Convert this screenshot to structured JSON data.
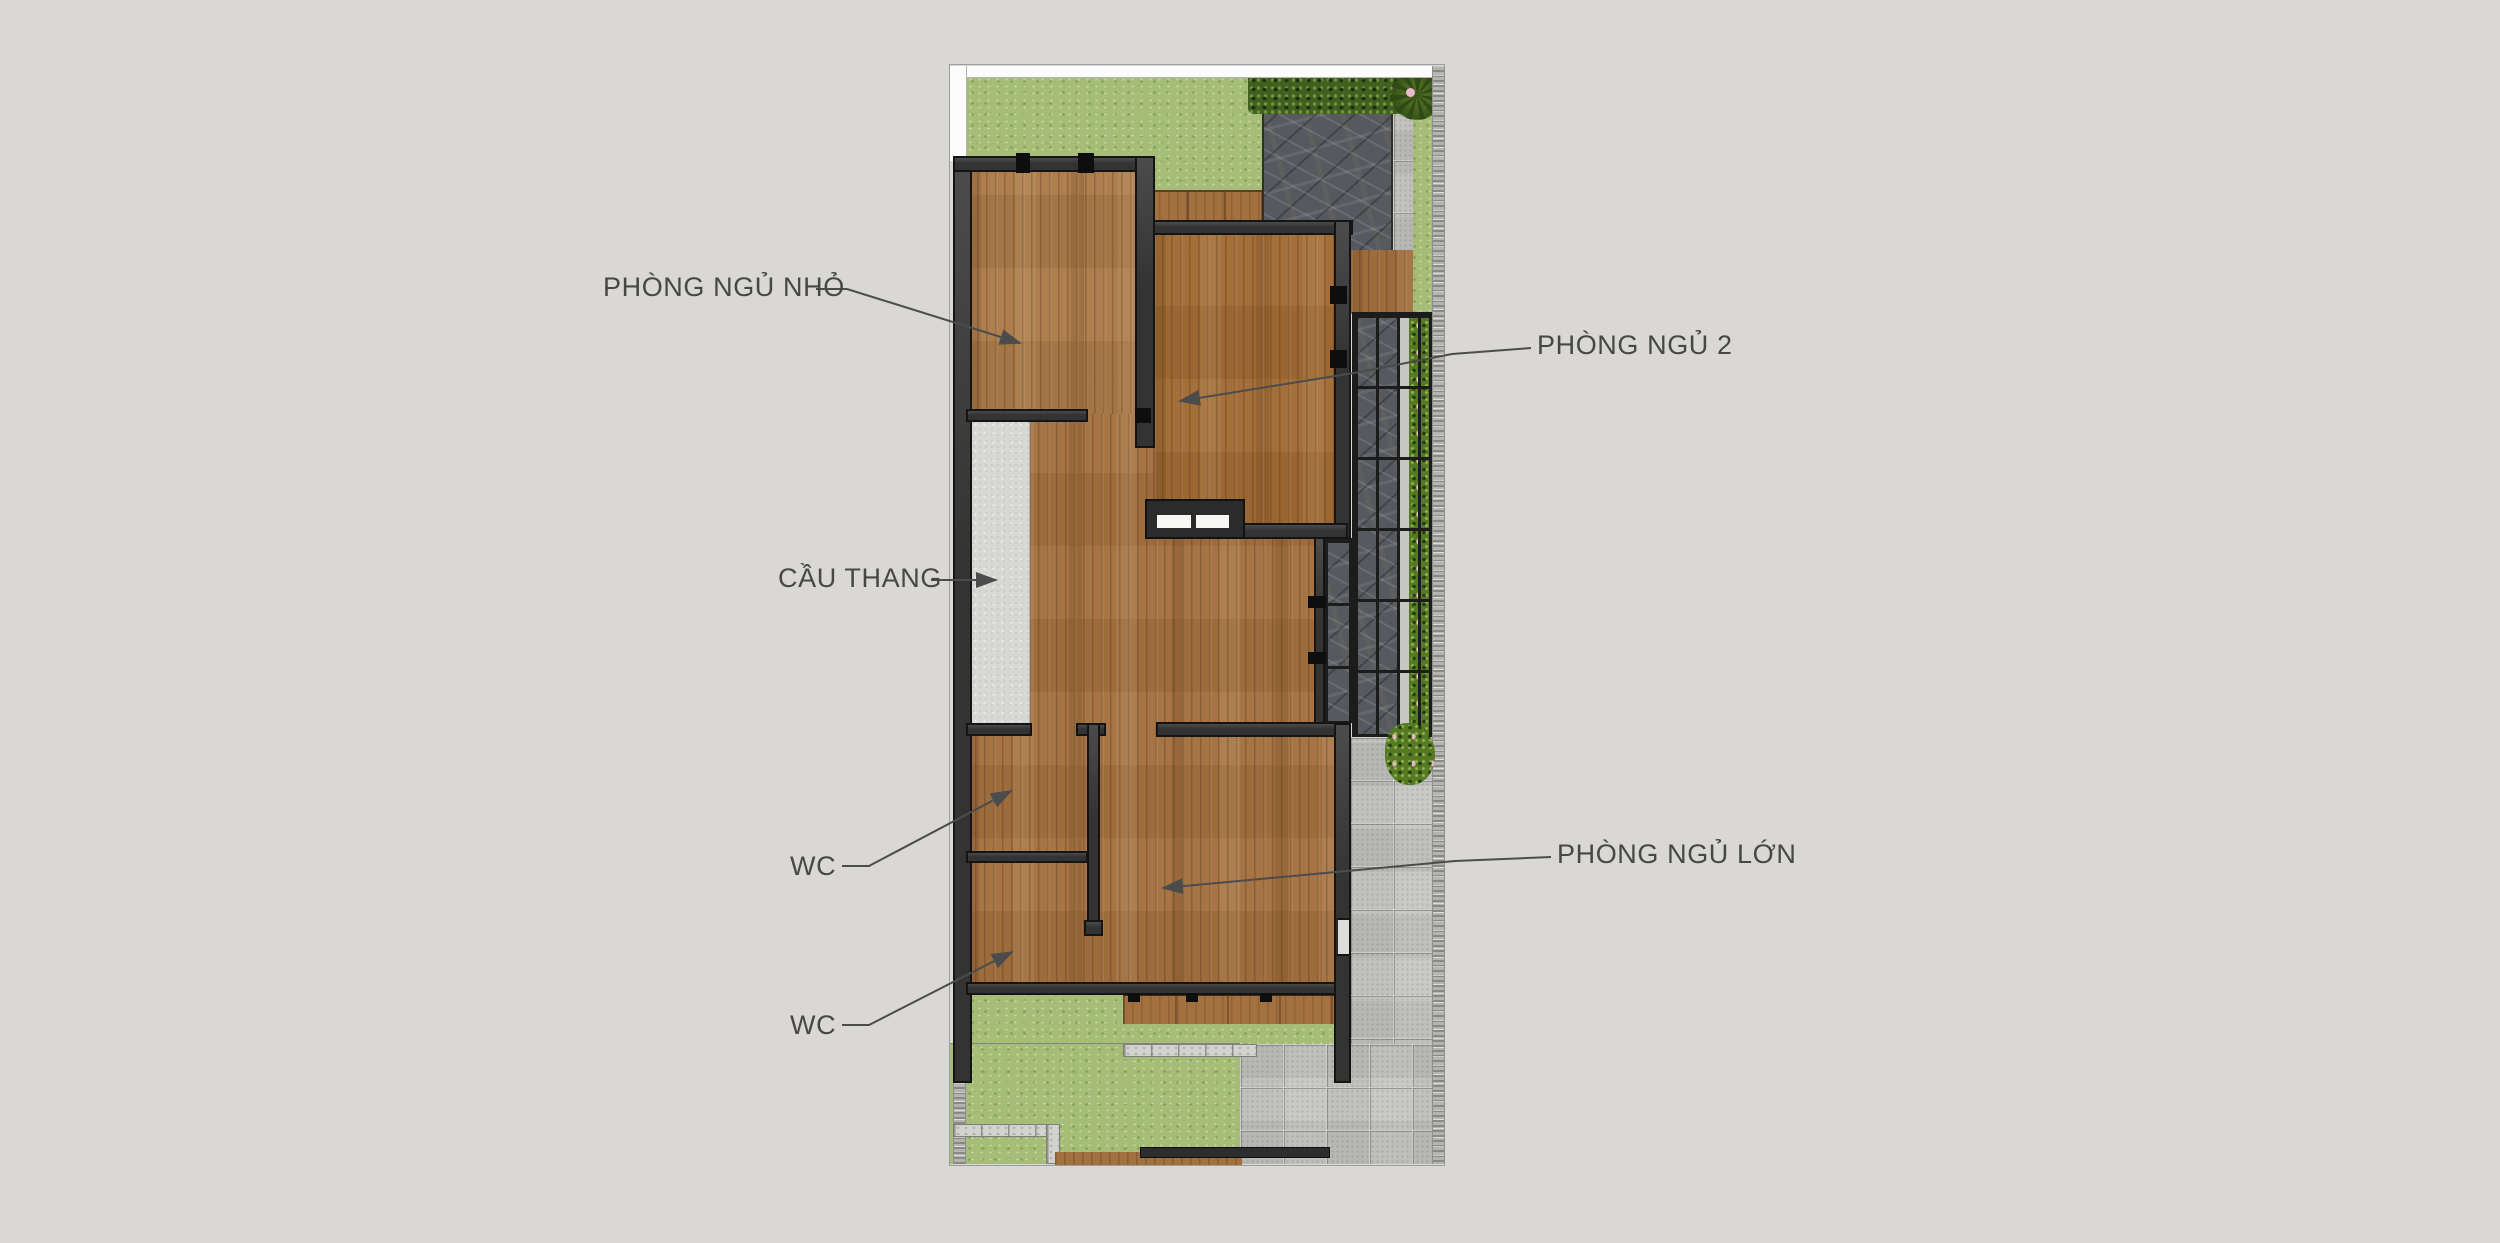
{
  "plan": {
    "type": "architectural floor plan (upper storey, top view)",
    "labels": {
      "small_bedroom": "PHÒNG NGỦ NHỎ",
      "bedroom_2": "PHÒNG NGỦ 2",
      "staircase": "CẦU THANG",
      "wc_upper": "WC",
      "large_bedroom": "PHÒNG NGỦ LỚN",
      "wc_lower": "WC"
    },
    "colors": {
      "page_background": "#d9d8d4",
      "label_text": "#474747",
      "leader_line": "#4c4c4c",
      "wall": "#333333",
      "wood_floor": "#a3703f",
      "grass": "#a5bd76",
      "slate_patio": "#565a5e",
      "pavers": "#c9c9c6",
      "staircase_concrete": "#d8d8d5",
      "hedge_green": "#41601f",
      "boundary_white": "#fcfcfc"
    }
  }
}
